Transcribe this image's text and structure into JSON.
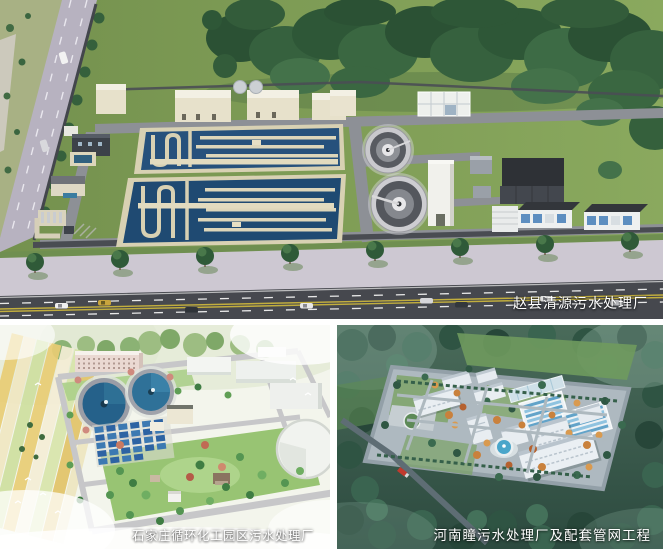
{
  "panels": {
    "top": {
      "caption": "赵县清源污水处理厂"
    },
    "bottom_left": {
      "caption": "石家庄循环化工园区污水处理厂"
    },
    "bottom_right": {
      "caption": "河南瞳污水处理厂及配套管网工程"
    }
  },
  "colors": {
    "caption_text": "#ffffff",
    "top_grass": "#7a9a58",
    "top_forest": "#2e5637",
    "top_basin_water": "#24507a",
    "top_basin_wall": "#d8d1b3",
    "top_road": "#46484e",
    "top_lane_yellow": "#c2ae3e",
    "bl_field_yellow": "#e9cd75",
    "bl_tank_water": "#25618a",
    "bl_panel_blue": "#3c79b2",
    "br_forest": "#2f5443",
    "br_basin_blue": "#62a3c9",
    "br_building": "#e8edf1"
  }
}
